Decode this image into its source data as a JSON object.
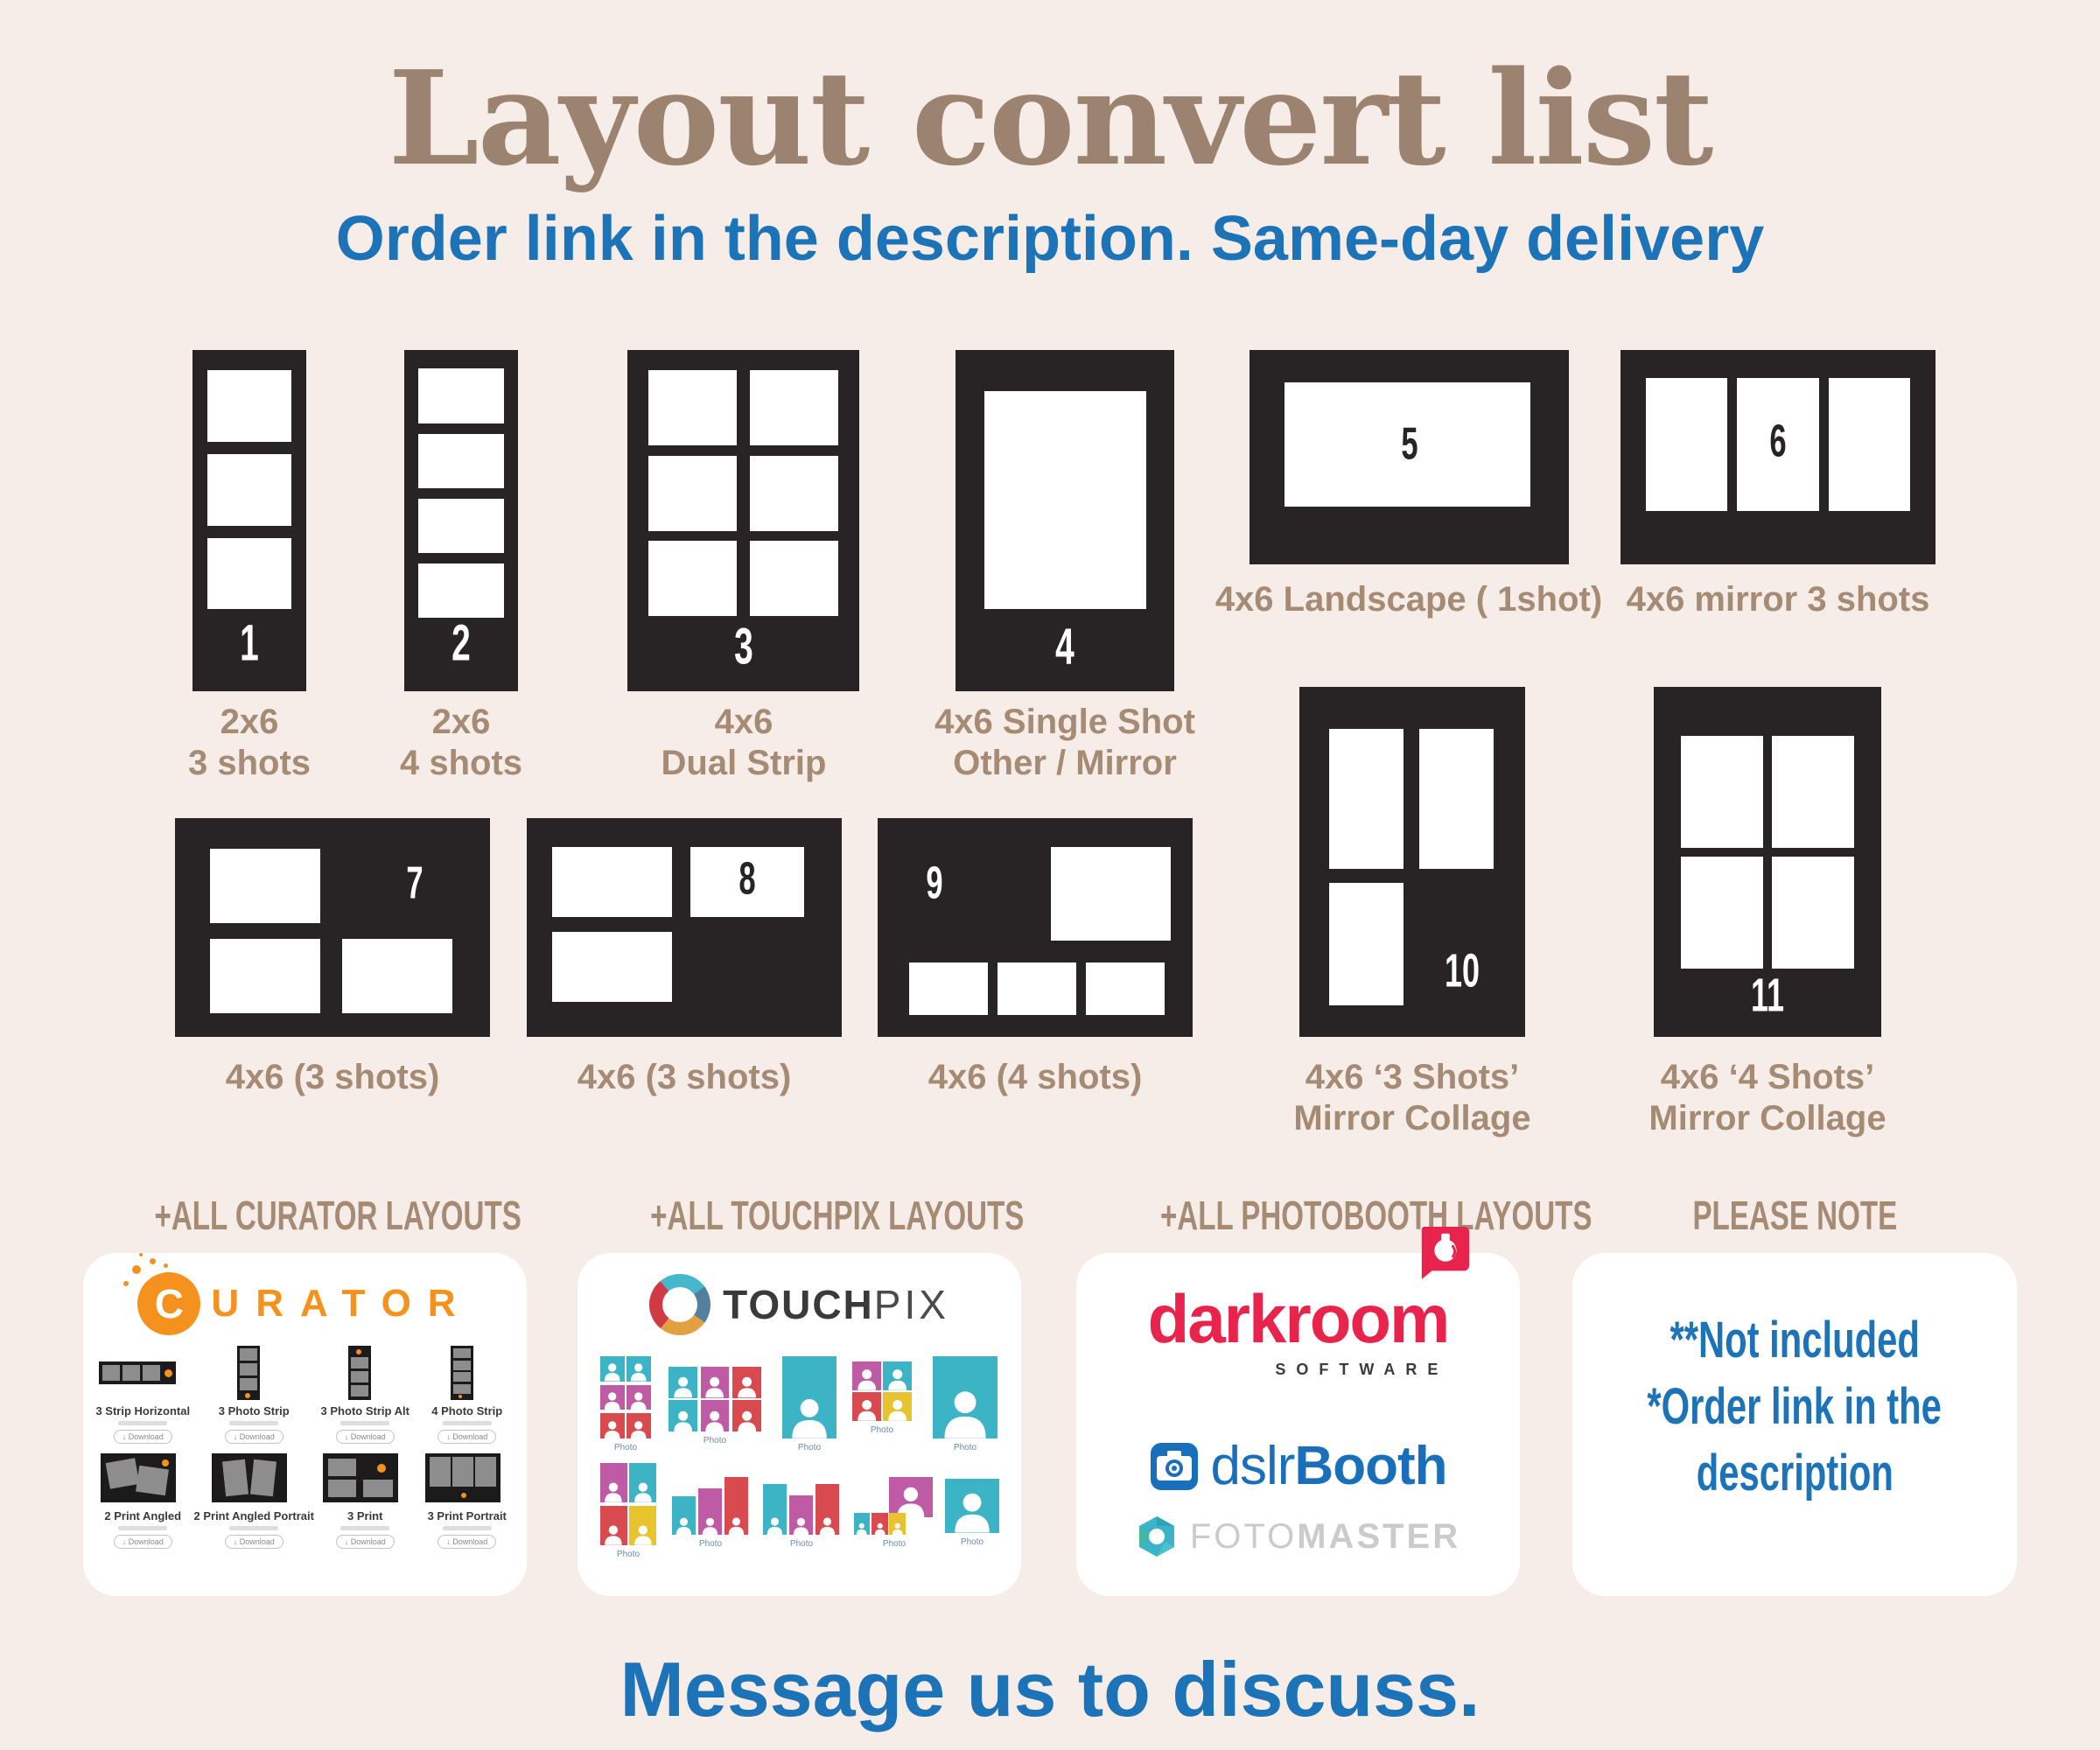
{
  "page": {
    "title": "Layout convert list",
    "subtitle": "Order link in the description. Same-day delivery",
    "footer": "Message us to discuss."
  },
  "colors": {
    "background": "#f7ede8",
    "tile_black": "#282324",
    "label_brown": "#a58a74",
    "accent_blue": "#1d73b8",
    "curator_orange": "#f5921e",
    "darkroom_red": "#e8234c",
    "dslr_blue": "#1a6fba",
    "foto_gray": "#c9cbcd",
    "tp_teal": "#3db4c5",
    "tp_magenta": "#bf5ba4",
    "tp_red": "#d94a4f",
    "tp_yellow": "#e7c32e"
  },
  "tiles": [
    {
      "num": "1",
      "label": "2x6\n3 shots"
    },
    {
      "num": "2",
      "label": "2x6\n4 shots"
    },
    {
      "num": "3",
      "label": "4x6\nDual Strip"
    },
    {
      "num": "4",
      "label": "4x6 Single Shot\nOther / Mirror"
    },
    {
      "num": "5",
      "label": "4x6 Landscape ( 1shot)"
    },
    {
      "num": "6",
      "label": "4x6 mirror 3 shots"
    },
    {
      "num": "7",
      "label": "4x6 (3 shots)"
    },
    {
      "num": "8",
      "label": "4x6 (3 shots)"
    },
    {
      "num": "9",
      "label": "4x6 (4 shots)"
    },
    {
      "num": "10",
      "label": "4x6 ‘3 Shots’\nMirror Collage"
    },
    {
      "num": "11",
      "label": "4x6 ‘4 Shots’\nMirror Collage"
    }
  ],
  "sections": {
    "curator": {
      "header": "+ALL CURATOR LAYOUTS",
      "brand": "CURATOR",
      "download_label": "↓ Download",
      "items": [
        {
          "caption": "3 Strip Horizontal",
          "kind": "strip3h"
        },
        {
          "caption": "3 Photo Strip",
          "kind": "strip3v"
        },
        {
          "caption": "3 Photo Strip Alt",
          "kind": "strip3v_alt"
        },
        {
          "caption": "4 Photo Strip",
          "kind": "strip4v"
        },
        {
          "caption": "2 Print Angled",
          "kind": "angled2"
        },
        {
          "caption": "2 Print Angled Portrait",
          "kind": "angled2p"
        },
        {
          "caption": "3 Print",
          "kind": "print3"
        },
        {
          "caption": "3 Print Portrait",
          "kind": "print3p"
        }
      ]
    },
    "touchpix": {
      "header": "+ALL TOUCHPIX LAYOUTS",
      "brand_bold": "TOUCH",
      "brand_light": "PIX",
      "captions": [
        "Photo",
        "Photo",
        "Photo",
        "Photo",
        "Photo",
        "Photo",
        "Photo",
        "Photo",
        "Photo",
        "Photo"
      ]
    },
    "photobooth": {
      "header": "+ALL PHOTOBOOTH LAYOUTS",
      "darkroom": "darkroom",
      "darkroom_sub": "SOFTWARE",
      "dslr_regular": "dslr",
      "dslr_bold": "Booth",
      "foto_light": "FOTO",
      "foto_bold": "MASTER"
    },
    "note": {
      "header": "PLEASE NOTE",
      "lines": [
        "**Not included",
        "*Order link in the",
        "description"
      ]
    }
  }
}
